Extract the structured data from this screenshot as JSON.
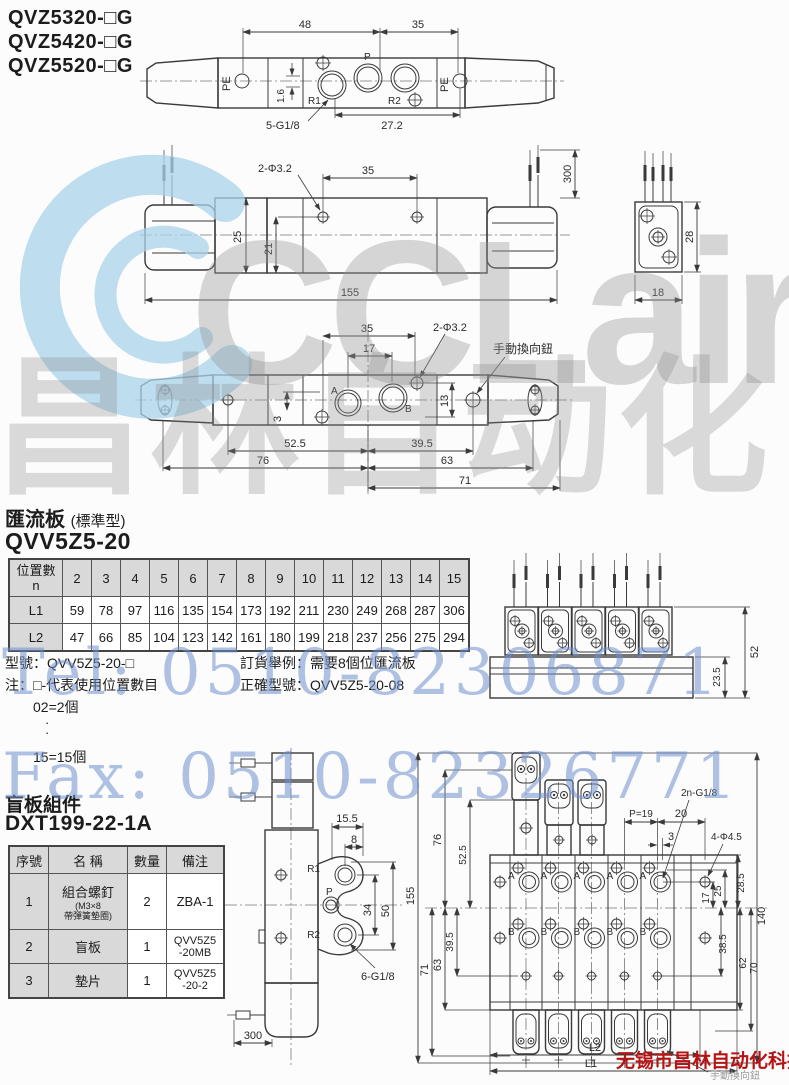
{
  "header": {
    "models": [
      "QVZ5320-□G",
      "QVZ5420-□G",
      "QVZ5520-□G"
    ]
  },
  "watermarks": {
    "logo": "CCLair",
    "brand": "昌林自动化",
    "tel": "Tel: 0510-82306871",
    "fax": "Fax: 0510-82326771",
    "company": "无锡市昌林自动化科技",
    "colors": {
      "logo_blue": "#a9d3ea",
      "letters_gray": "#969696",
      "phone_blue": "#6e8fcd",
      "company_red": "#b41414"
    }
  },
  "d1": {
    "d48": "48",
    "d35": "35",
    "pe_left": "PE",
    "r1": "R1",
    "p": "P",
    "r2": "R2",
    "pe_right": "PE",
    "d16": "1.6",
    "thread": "5-G1/8",
    "d272": "27.2"
  },
  "d2": {
    "holes": "2-Φ3.2",
    "d35": "35",
    "d25": "25",
    "d21": "21",
    "d155": "155",
    "d300": "300",
    "d28": "28",
    "d18": "18"
  },
  "d3": {
    "d35": "35",
    "d17": "17",
    "holes": "2-Φ3.2",
    "manual": "手動換向鈕",
    "a": "A",
    "b": "B",
    "d3": "3",
    "d13": "13",
    "d525": "52.5",
    "d395": "39.5",
    "d76": "76",
    "d63": "63",
    "d71": "71"
  },
  "sec1": {
    "title": "匯流板",
    "subtitle": "(標準型)",
    "model": "QVV5Z5-20",
    "table": {
      "corner_line1": "位置數",
      "corner_line2": "n",
      "cols": [
        "2",
        "3",
        "4",
        "5",
        "6",
        "7",
        "8",
        "9",
        "10",
        "11",
        "12",
        "13",
        "14",
        "15"
      ],
      "l1_label": "L1",
      "l1": [
        "59",
        "78",
        "97",
        "116",
        "135",
        "154",
        "173",
        "192",
        "211",
        "230",
        "249",
        "268",
        "287",
        "306"
      ],
      "l2_label": "L2",
      "l2": [
        "47",
        "66",
        "85",
        "104",
        "123",
        "142",
        "161",
        "180",
        "199",
        "218",
        "237",
        "256",
        "275",
        "294"
      ]
    },
    "note_model": "型號：QVV5Z5-20-□",
    "note_note": "注：□-代表使用位置數目",
    "note_eq1": "02=2個",
    "note_dot": "·",
    "note_eq2": "15=15個",
    "note_order1": "訂貨舉例：需要8個位匯流板",
    "note_order2": "正確型號：QVV5Z5-20-08",
    "d52": "52",
    "d235": "23.5"
  },
  "sec2": {
    "title": "盲板組件",
    "model": "DXT199-22-1A",
    "table": {
      "h_no": "序號",
      "h_name": "名 稱",
      "h_qty": "數量",
      "h_rk": "備注",
      "r1_no": "1",
      "r1_name": "組合螺釘",
      "r1_sub1": "(M3×8",
      "r1_sub2": "帶彈簧墊圈)",
      "r1_qty": "2",
      "r1_rk": "ZBA-1",
      "r2_no": "2",
      "r2_name": "盲板",
      "r2_qty": "1",
      "r2_rk1": "QVV5Z5",
      "r2_rk2": "-20MB",
      "r3_no": "3",
      "r3_name": "墊片",
      "r3_qty": "1",
      "r3_rk1": "QVV5Z5",
      "r3_rk2": "-20-2"
    }
  },
  "d5": {
    "d155": "15.5",
    "d8": "8",
    "r1": "R1",
    "p": "P",
    "r2": "R2",
    "d34": "34",
    "d50": "50",
    "thread": "6-G1/8",
    "d300": "300"
  },
  "d6": {
    "thread": "2n-G1/8",
    "pitch": "P=19",
    "d20": "20",
    "d3": "3",
    "holes": "4-Φ4.5",
    "d155": "155",
    "d76": "76",
    "d525": "52.5",
    "d395": "39.5",
    "d63": "63",
    "d71": "71",
    "d140": "140",
    "d285": "28.5",
    "d25": "25",
    "d17": "17",
    "d385": "38.5",
    "d62": "62",
    "d70": "70",
    "l1": "L1",
    "l2": "L2",
    "a": "A",
    "b": "B",
    "manual": "手動換向鈕"
  }
}
